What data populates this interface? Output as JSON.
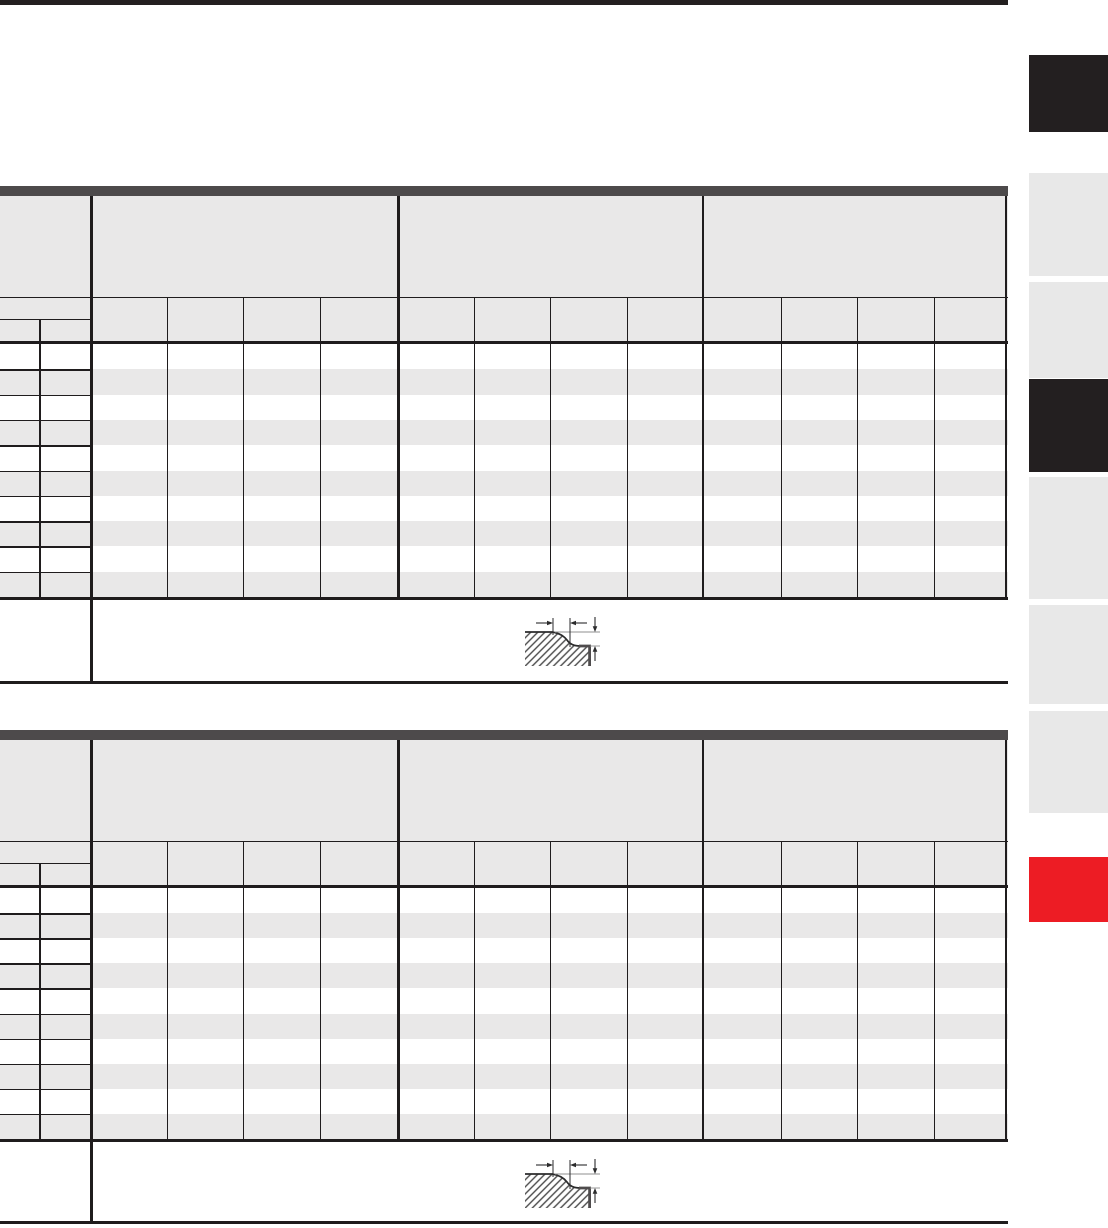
{
  "page": {
    "background": "#ffffff",
    "top_rule_color": "#231f20"
  },
  "palette": {
    "table_accent_bar": "#4d4a4b",
    "table_header_fill": "#e9e8e8",
    "row_stripe_fill": "#e9e8e8",
    "grid_line": "#1f1c1d",
    "tab_dark": "#231f20",
    "tab_gray": "#e8e8e8",
    "tab_red": "#ed1c24",
    "drawing_line": "#2b2b2c",
    "drawing_heavy_line": "#4f4c4d",
    "drawing_level_line": "#8f8f8f",
    "hatch_line": "#4a4a4a"
  },
  "side_tabs": [
    {
      "id": "side-tab-1",
      "variant": "dark"
    },
    {
      "id": "side-tab-2",
      "variant": "gray"
    },
    {
      "id": "side-tab-3",
      "variant": "gray"
    },
    {
      "id": "side-tab-4",
      "variant": "dark"
    },
    {
      "id": "side-tab-5",
      "variant": "gray"
    },
    {
      "id": "side-tab-6",
      "variant": "gray"
    },
    {
      "id": "side-tab-7",
      "variant": "gray"
    },
    {
      "id": "side-tab-8",
      "variant": "red"
    }
  ],
  "tables": [
    {
      "id": "upper-spec-table",
      "column_groups": 3,
      "columns_per_group": 4,
      "size_header_columns": 2,
      "data_rows": 10,
      "row_stripe_pattern": "alternating",
      "cells_text": "",
      "footer_drawing": "stepped-recess-profile"
    },
    {
      "id": "lower-spec-table",
      "column_groups": 3,
      "columns_per_group": 4,
      "size_header_columns": 2,
      "data_rows": 10,
      "row_stripe_pattern": "alternating",
      "cells_text": "",
      "footer_drawing": "stepped-recess-profile"
    }
  ]
}
